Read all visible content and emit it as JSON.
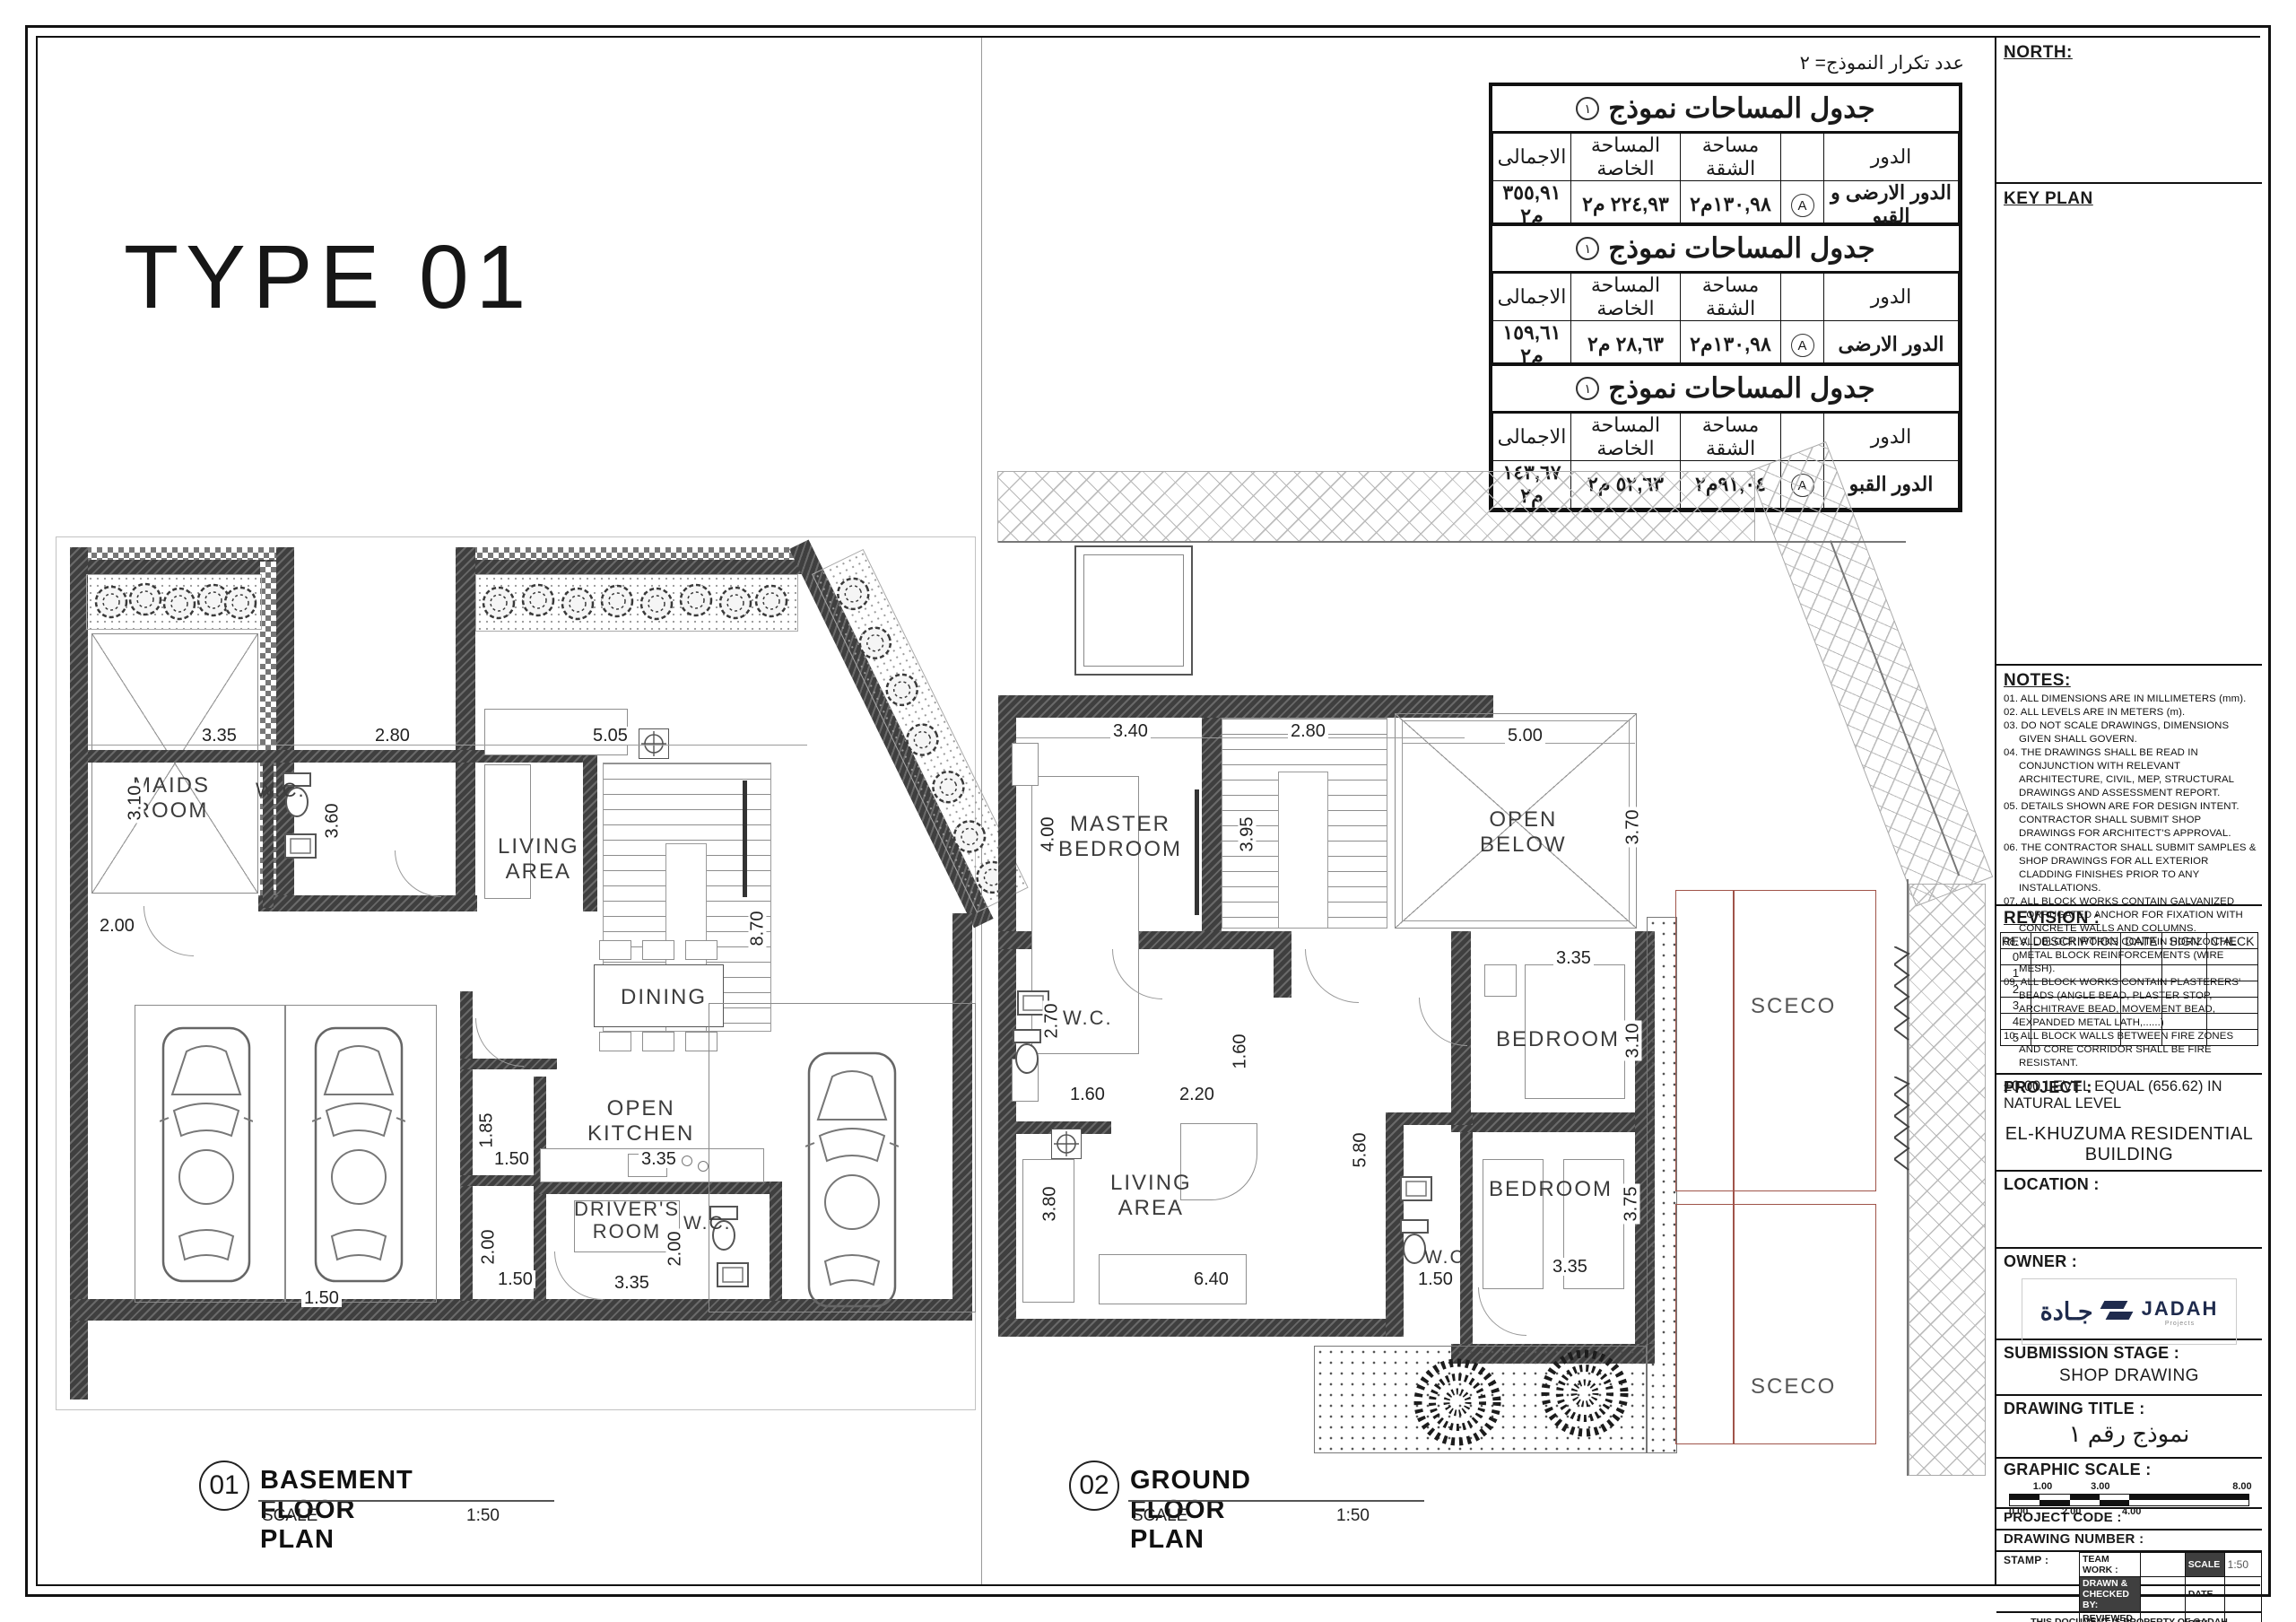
{
  "page": {
    "type_title": "TYPE 01",
    "repeat_note": "عدد تكرار النموذج= ٢"
  },
  "table_headers": {
    "floor": "الدور",
    "apartment": "مساحة الشقة",
    "private": "المساحة الخاصة",
    "total": "الاجمالى"
  },
  "area_tables": [
    {
      "title": "جدول المساحات نموذج",
      "badge": "١",
      "unit": "A",
      "floor": "الدور الارضى و القبو",
      "apartment": "١٣٠,٩٨م٢",
      "private": "٢٢٤,٩٣ م٢",
      "total": "٣٥٥,٩١ م٢"
    },
    {
      "title": "جدول المساحات نموذج",
      "badge": "١",
      "unit": "A",
      "floor": "الدور الارضى",
      "apartment": "١٣٠,٩٨م٢",
      "private": "٢٨,٦٣ م٢",
      "total": "١٥٩,٦١ م٢"
    },
    {
      "title": "جدول المساحات نموذج",
      "badge": "١",
      "unit": "A",
      "floor": "الدور القبو",
      "apartment": "٩١,٠٤م٢",
      "private": "٥٢,٦٣ م٢",
      "total": "١٤٣,٦٧ م٢"
    }
  ],
  "basement": {
    "number": "01",
    "title": "BASEMENT FLOOR PLAN",
    "scale_label": "SCALE",
    "scale_value": "1:50",
    "rooms": [
      "MAIDS\nROOM",
      "W.C.",
      "LIVING\nAREA",
      "DINING",
      "OPEN\nKITCHEN",
      "DRIVER'S\nROOM",
      "W.C."
    ],
    "dims": [
      "3.35",
      "2.80",
      "5.05",
      "3.10",
      "3.60",
      "2.00",
      "8.70",
      "3.35",
      "1.85",
      "1.50",
      "2.00",
      "1.50",
      "3.35",
      "2.00",
      "1.50"
    ]
  },
  "ground": {
    "number": "02",
    "title": "GROUND FLOOR PLAN",
    "scale_label": "SCALE",
    "scale_value": "1:50",
    "rooms": [
      "MASTER\nBEDROOM",
      "OPEN\nBELOW",
      "W.C.",
      "BEDROOM",
      "BEDROOM",
      "LIVING\nAREA",
      "W.C",
      "SCECO",
      "SCECO"
    ],
    "dims": [
      "3.40",
      "2.80",
      "5.00",
      "4.00",
      "3.95",
      "3.70",
      "2.70",
      "1.60",
      "2.20",
      "1.60",
      "3.35",
      "3.10",
      "3.80",
      "6.40",
      "5.80",
      "1.50",
      "3.35",
      "3.75"
    ]
  },
  "sidebar": {
    "north_label": "NORTH:",
    "key_plan_label": "KEY PLAN",
    "notes_label": "NOTES:",
    "notes": [
      "01. ALL DIMENSIONS ARE IN MILLIMETERS (mm).",
      "02. ALL LEVELS ARE IN METERS (m).",
      "03. DO NOT SCALE DRAWINGS, DIMENSIONS GIVEN SHALL GOVERN.",
      "04. THE DRAWINGS SHALL BE READ IN CONJUNCTION WITH RELEVANT ARCHITECTURE, CIVIL, MEP, STRUCTURAL DRAWINGS AND ASSESSMENT REPORT.",
      "05. DETAILS SHOWN ARE FOR DESIGN INTENT. CONTRACTOR SHALL SUBMIT SHOP DRAWINGS FOR ARCHITECT'S APPROVAL.",
      "06. THE CONTRACTOR  SHALL SUBMIT SAMPLES & SHOP DRAWINGS FOR ALL EXTERIOR CLADDING FINISHES PRIOR TO ANY INSTALLATIONS.",
      "07. ALL BLOCK WORKS CONTAIN GALVANIZED CORRUGATED ANCHOR FOR FIXATION WITH CONCRETE WALLS AND COLUMNS.",
      "08. ALL BLOCK WORKS CONTAIN HORIZONTAL METAL BLOCK REINFORCEMENTS (WIRE MESH).",
      "09. ALL BLOCK WORKS CONTAIN PLASTERERS' BEADS (ANGLE BEAD, PLASTER STOP, ARCHITRAVE BEAD, MOVEMENT BEAD, EXPANDED METAL LATH,......)",
      "10. ALL BLOCK WALLS BETWEEN FIRE ZONES AND CORE CORRIDOR SHALL BE FIRE RESISTANT."
    ],
    "level_note": "±0.00 LEVEL EQUAL (656.62) IN NATURAL LEVEL",
    "revision_label": "REVISION :",
    "revision_headers": [
      "REV.",
      "DESCRIPTION",
      "DATE",
      "SIGN",
      "CHECK"
    ],
    "revision_rows": [
      "0",
      "1",
      "2",
      "3",
      "4",
      "5"
    ],
    "project_label": "PROJECT :",
    "project_value": "EL-KHUZUMA RESIDENTIAL BUILDING",
    "location_label": "LOCATION :",
    "owner_label": "OWNER :",
    "owner_logo_arabic": "جـادة",
    "owner_logo_latin": "JADAH",
    "owner_logo_sub": "Projects",
    "submission_label": "SUBMISSION  STAGE :",
    "submission_value": "SHOP DRAWING",
    "drawing_title_label": "DRAWING  TITLE :",
    "drawing_title_value": "نموذج رقم ١",
    "graphic_scale_label": "GRAPHIC  SCALE :",
    "scale_top_nums": [
      "1.00",
      "3.00",
      "8.00"
    ],
    "scale_bottom_nums": [
      "0.00",
      "2.00",
      "4.00"
    ],
    "project_code_label": "PROJECT  CODE :",
    "drawing_number_label": "DRAWING  NUMBER :",
    "stamp_label": "STAMP :",
    "stamp": {
      "team_work": "TEAM WORK :",
      "drawn": "DRAWN & CHECKED BY:",
      "reviewed": "REVIEWED :",
      "approved": "APPROVED :",
      "scale_label": "SCALE",
      "scale_value": "1:50",
      "date_label": "DATE",
      "rev_label": "REV."
    },
    "footer_line1": "THIS DOCUMENT IS PROPERTY OF GADAH",
    "footer_line2": "NO USE OR REPRODUCTION IS PERMITTED WITHOUT WRITTEN PERMISSION"
  }
}
